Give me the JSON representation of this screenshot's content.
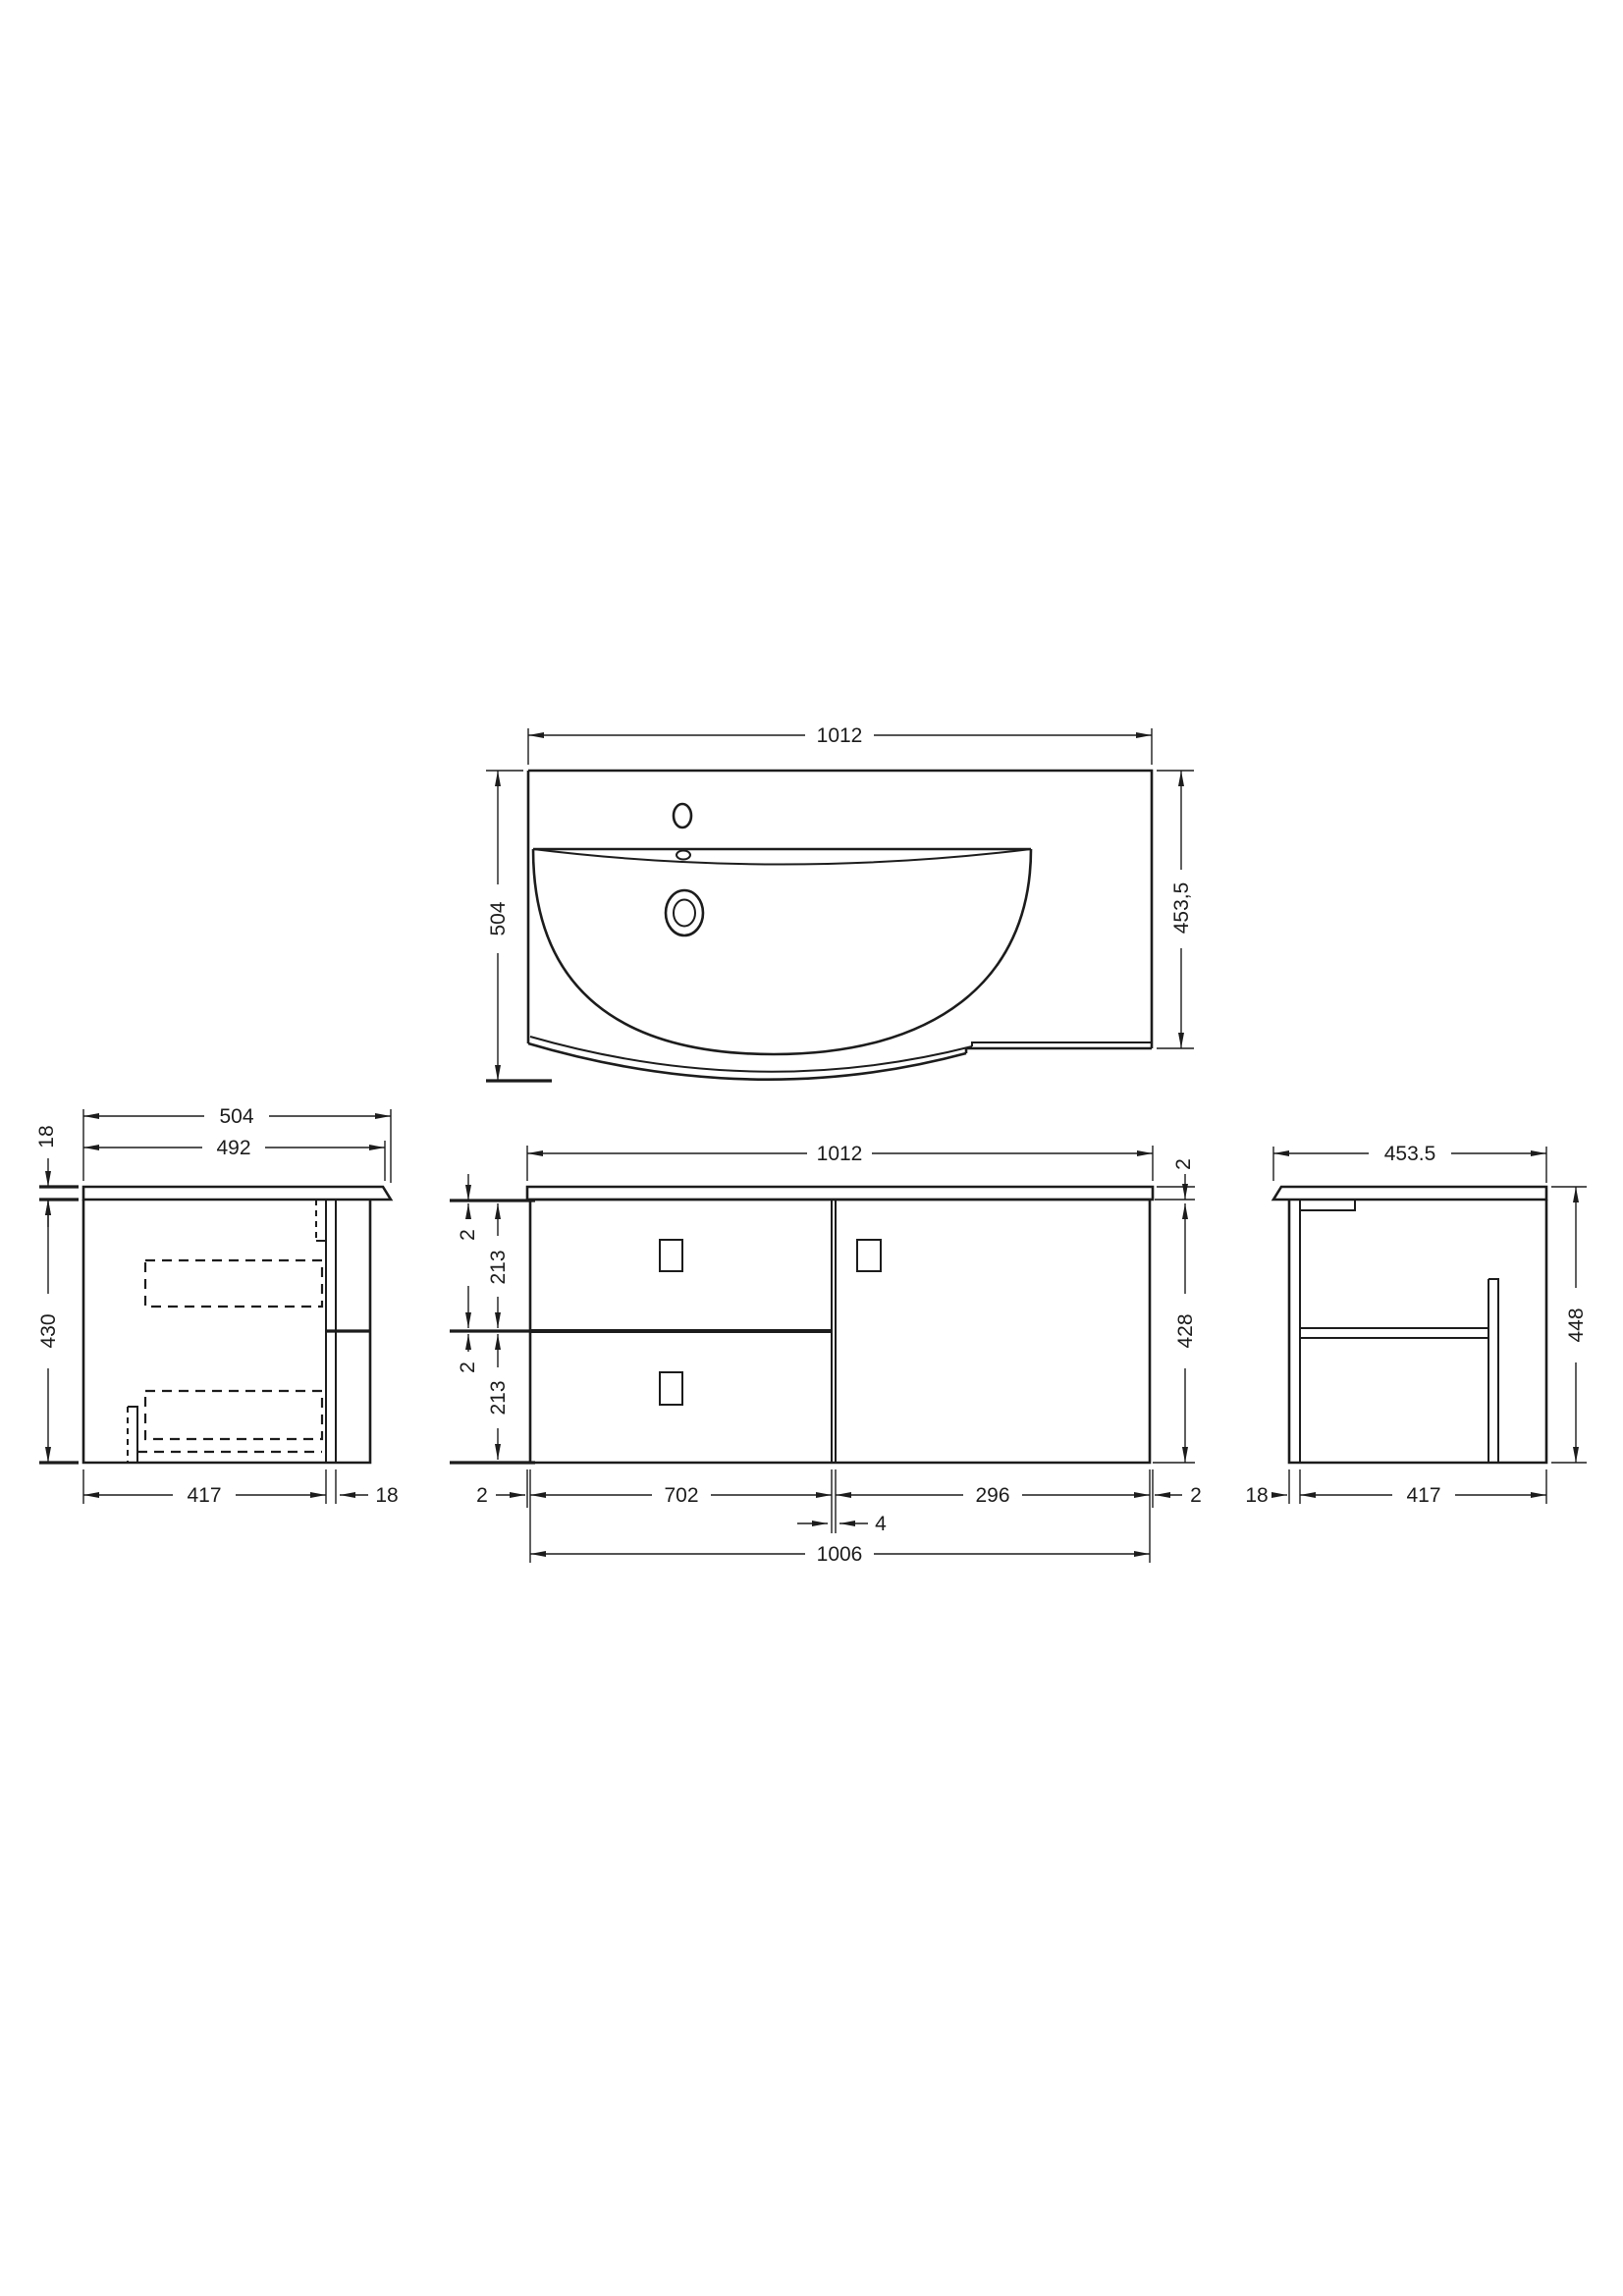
{
  "drawing": {
    "background": "#ffffff",
    "line_color": "#1c1c1c",
    "views": {
      "plan": {
        "label": "basin plan view",
        "dims": {
          "width": "1012",
          "depth_left": "504",
          "depth_right": "453,5"
        }
      },
      "front": {
        "label": "front elevation",
        "dims": {
          "overall_width": "1012",
          "top_gap": "2",
          "upper_drawer_height": "213",
          "mid_gap": "2",
          "lower_drawer_height": "213",
          "worktop_gap_right": "2",
          "cabinet_height": "428",
          "left_edge": "2",
          "drawer_width": "702",
          "divider_gap": "4",
          "door_width": "296",
          "right_edge": "2",
          "cabinet_width": "1006"
        }
      },
      "left_side": {
        "label": "left side elevation",
        "dims": {
          "overall_depth": "504",
          "inner_depth": "492",
          "worktop_thickness": "18",
          "carcass_height": "430",
          "carcass_depth": "417",
          "front_thickness": "18"
        }
      },
      "right_side": {
        "label": "right side elevation",
        "dims": {
          "overall_depth": "453.5",
          "overall_height": "448",
          "front_thickness": "18",
          "carcass_depth": "417"
        }
      }
    }
  }
}
